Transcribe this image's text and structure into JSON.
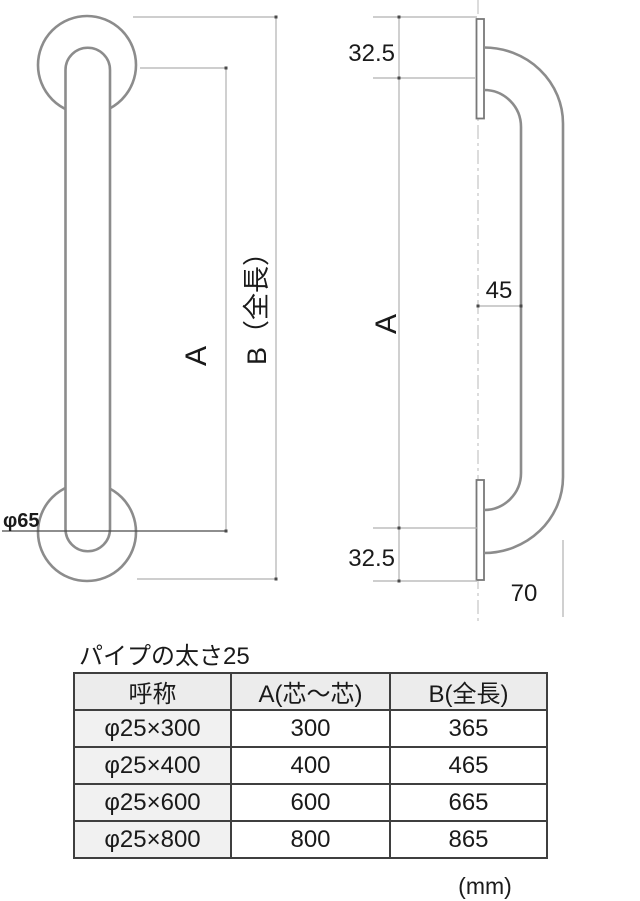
{
  "drawing": {
    "front_view": {
      "dim_a_label": "A",
      "dim_b_label": "B（全長）",
      "flange_diameter_label": "φ65"
    },
    "side_view": {
      "dim_top_offset": "32.5",
      "dim_wall_clearance": "45",
      "dim_a_label": "A",
      "dim_bottom_offset": "32.5",
      "dim_depth": "70"
    }
  },
  "table": {
    "title": "パイプの太さ25",
    "headers": [
      "呼称",
      "A(芯～芯)",
      "B(全長)"
    ],
    "rows": [
      [
        "φ25×300",
        "300",
        "365"
      ],
      [
        "φ25×400",
        "400",
        "465"
      ],
      [
        "φ25×600",
        "600",
        "665"
      ],
      [
        "φ25×800",
        "800",
        "865"
      ]
    ],
    "unit_note": "(mm)"
  },
  "colors": {
    "outline": "#8c8c8c",
    "dim_line": "#b0b0b0",
    "dim_dark": "#4a4a4a",
    "centerline": "#c4c4c4",
    "text": "#1a1a1a",
    "table_border": "#3f3f3f",
    "table_header_bg": "#ececec",
    "table_first_col_bg": "#f1f1f1"
  }
}
